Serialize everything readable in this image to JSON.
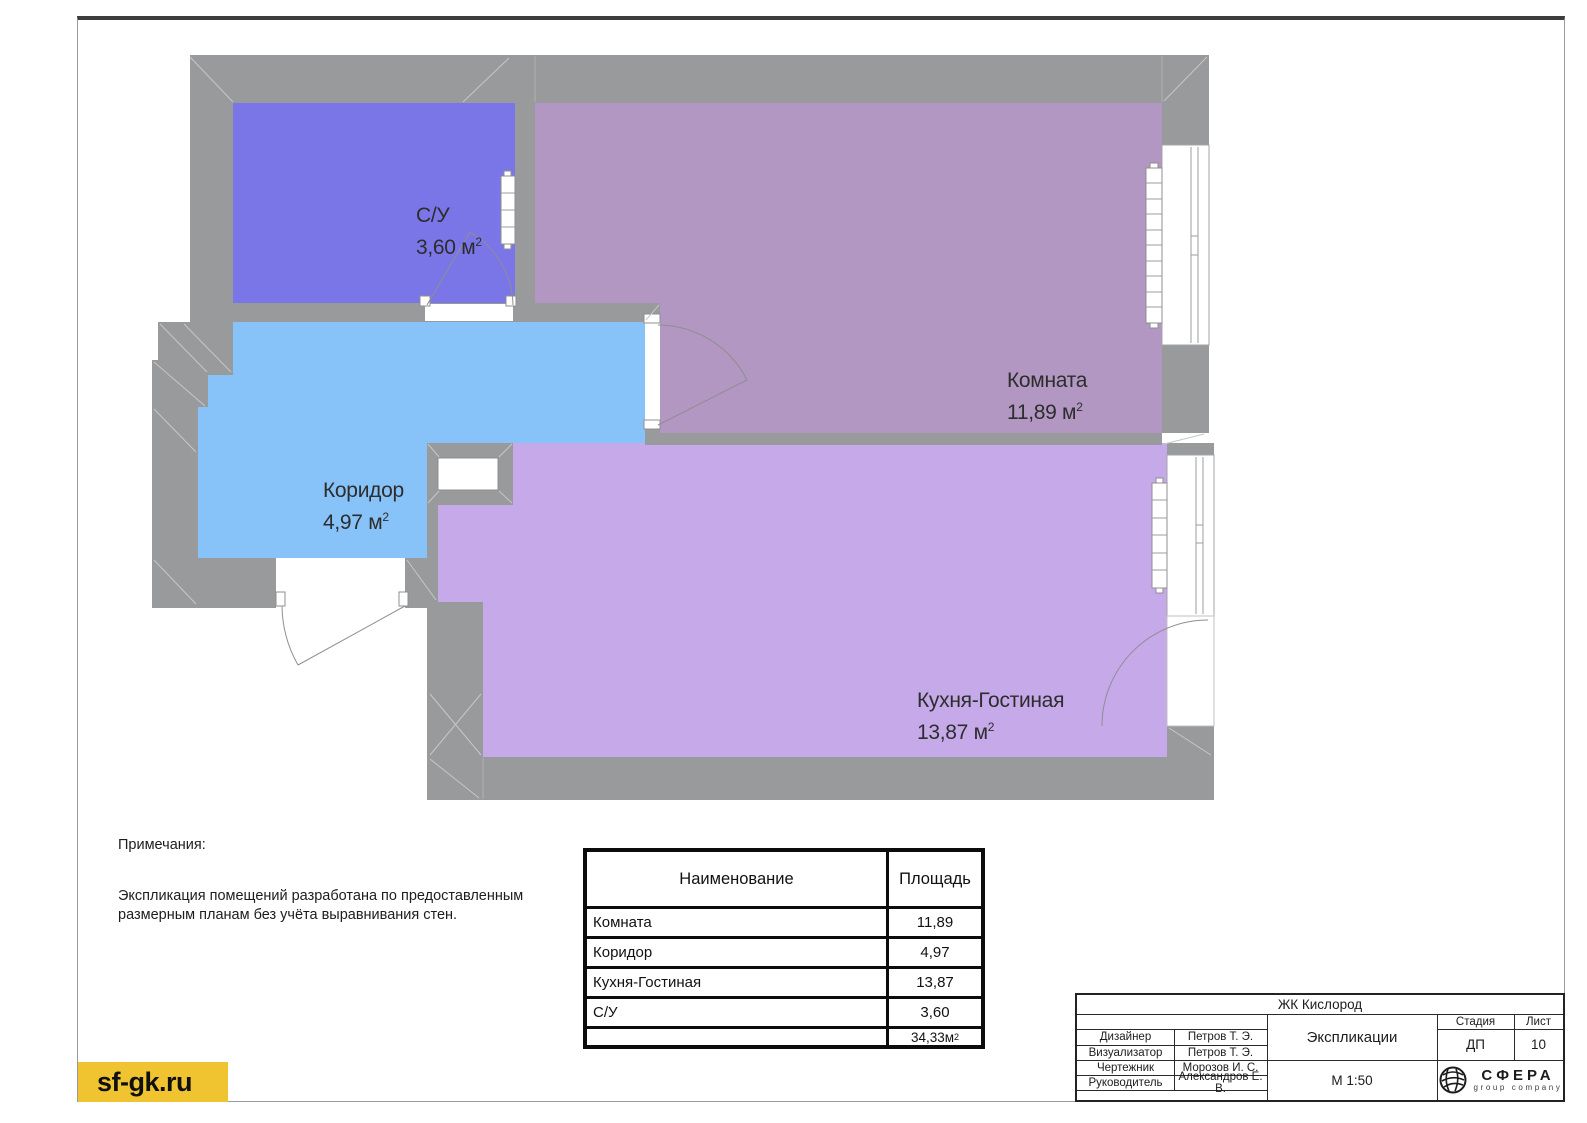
{
  "misc": {
    "unit": " м",
    "sup": "2"
  },
  "plan": {
    "wall_color": "#999a9b",
    "rooms": [
      {
        "id": "sy",
        "name": "С/У",
        "area": "3,60",
        "color": "#7b76e8"
      },
      {
        "id": "komnata",
        "name": "Комната",
        "area": "11,89",
        "color": "#b297c2"
      },
      {
        "id": "koridor",
        "name": "Коридор",
        "area": "4,97",
        "color": "#87c3f8"
      },
      {
        "id": "kuhnya",
        "name": "Кухня-Гостиная",
        "area": "13,87",
        "color": "#c5a9e9"
      }
    ]
  },
  "notes": {
    "title": "Примечания:",
    "body1": "Экспликация помещений разработана по предоставленным",
    "body2": "размерным планам без учёта выравнивания стен."
  },
  "table": {
    "headers": {
      "name": "Наименование",
      "area": "Площадь"
    },
    "rows": [
      {
        "name": "Комната",
        "area": "11,89"
      },
      {
        "name": "Коридор",
        "area": "4,97"
      },
      {
        "name": "Кухня-Гостиная",
        "area": "13,87"
      },
      {
        "name": "С/У",
        "area": "3,60"
      }
    ],
    "total": {
      "value": "34,33"
    }
  },
  "titleblock": {
    "project": "ЖК Кислород",
    "doc_title": "Экспликации",
    "scale": "М 1:50",
    "stage_label": "Стадия",
    "sheet_label": "Лист",
    "stage": "ДП",
    "sheet": "10",
    "roles": [
      {
        "label": "Дизайнер",
        "name": "Петров Т. Э."
      },
      {
        "label": "Визуализатор",
        "name": "Петров Т. Э."
      },
      {
        "label": "Чертежник",
        "name": "Морозов И. С."
      },
      {
        "label": "Руководитель",
        "name": "Александров Е. В."
      }
    ],
    "logo": {
      "brand": "СФЕРА",
      "tagline": "group company"
    }
  },
  "footer": {
    "site": "sf-gk.ru",
    "badge_color": "#f0c431"
  }
}
